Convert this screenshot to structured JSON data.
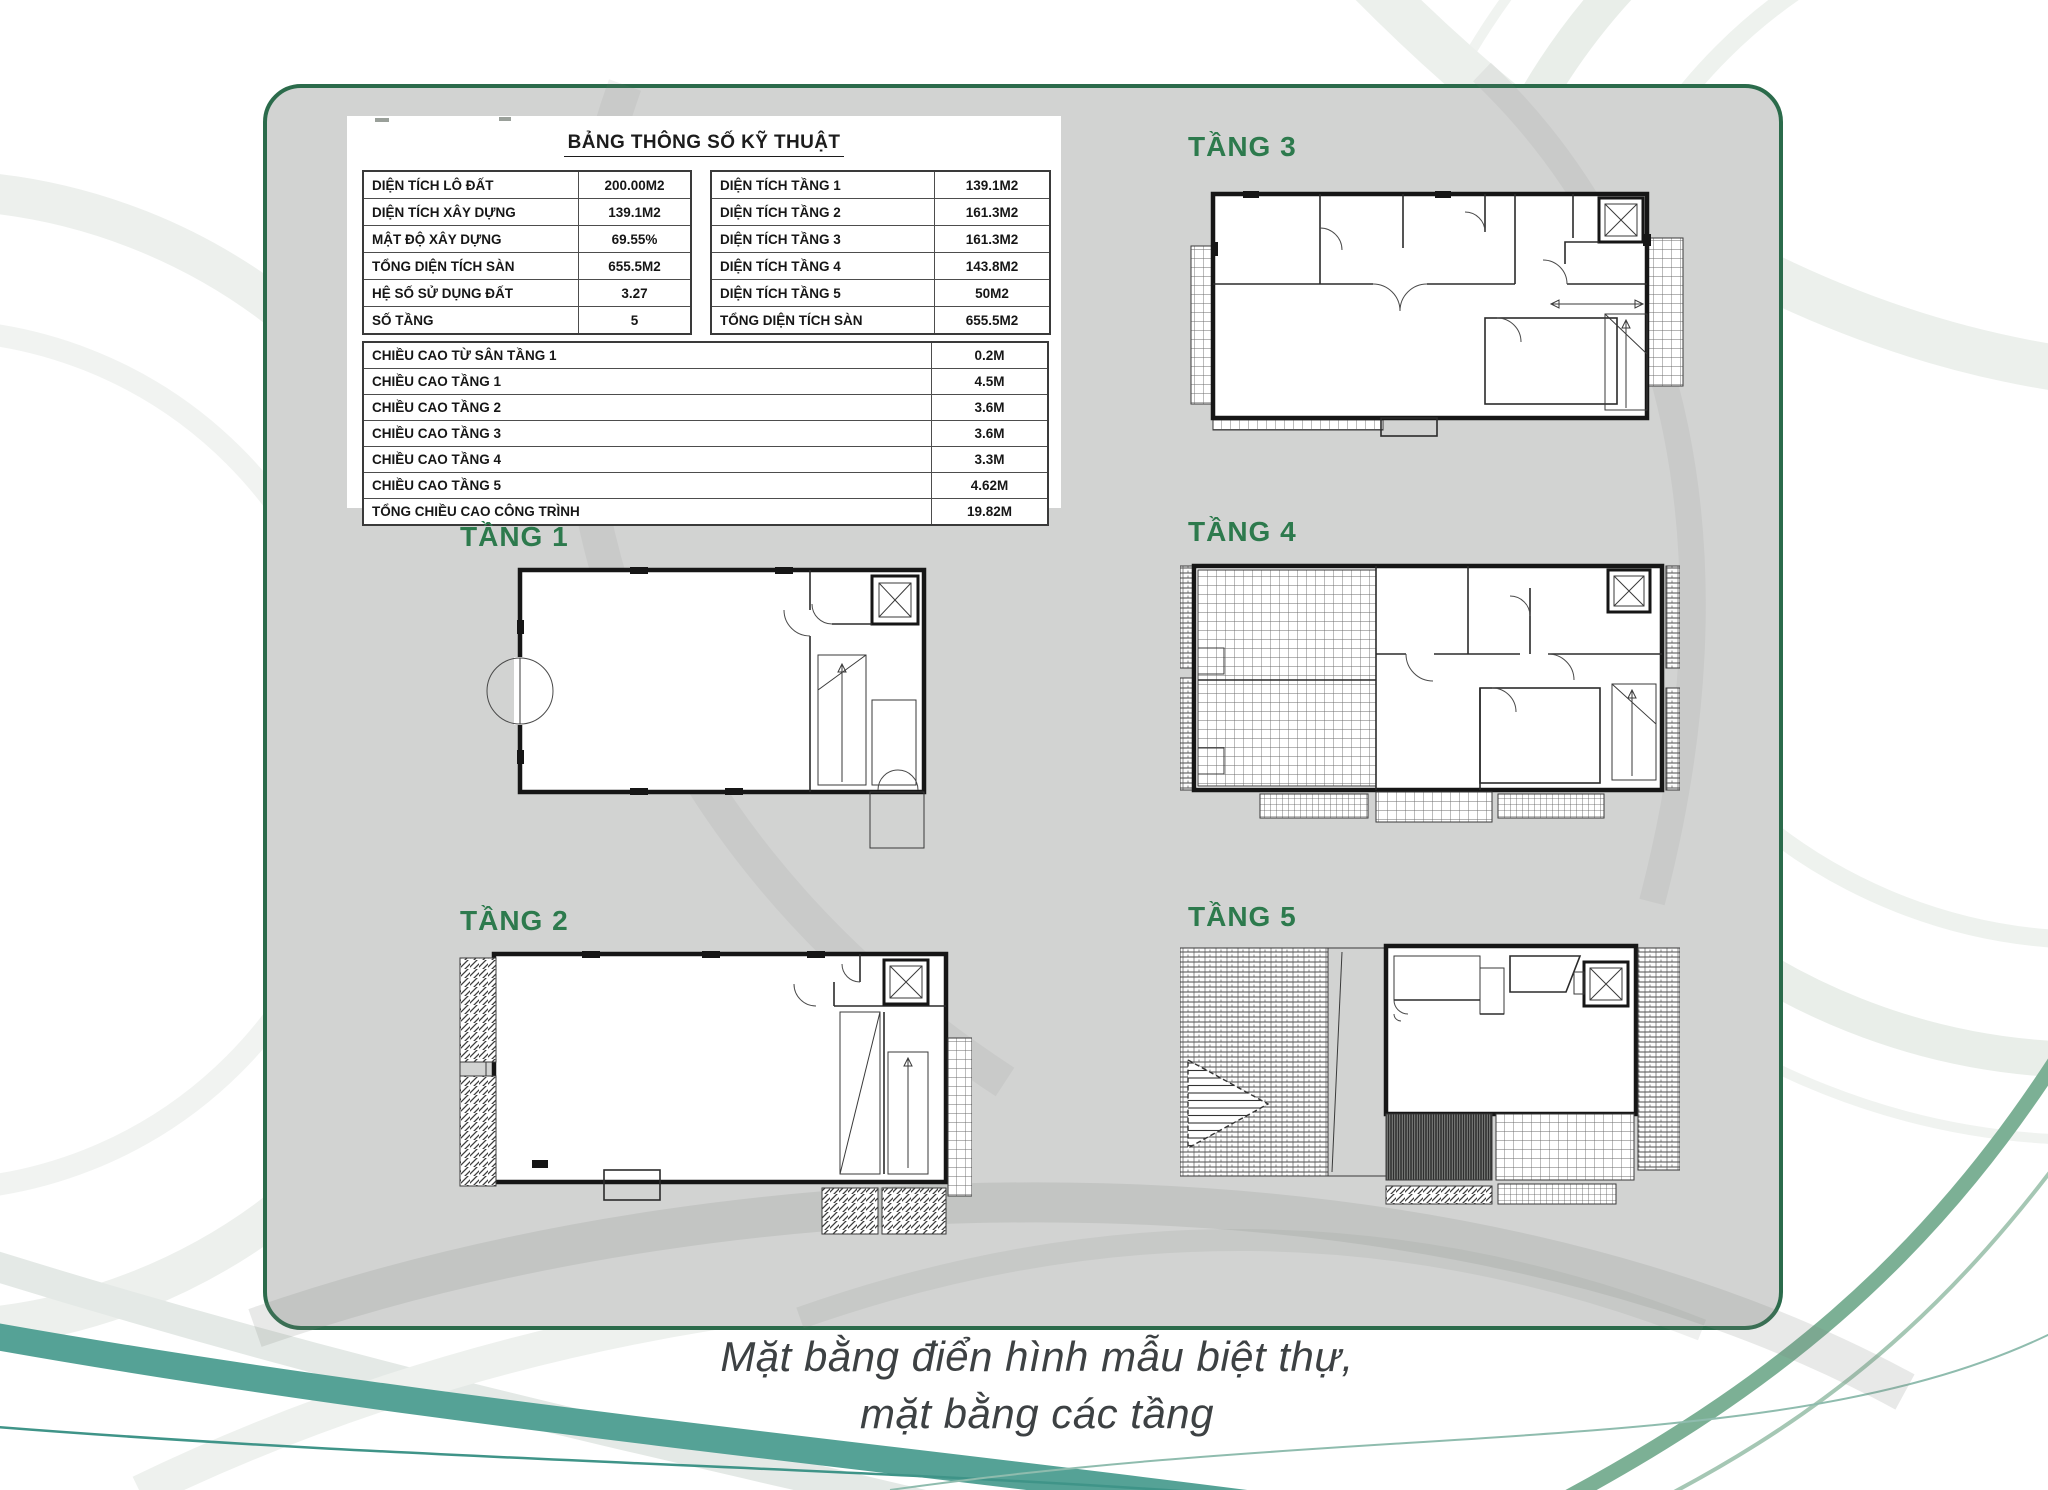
{
  "colors": {
    "accent_green": "#2d7a4d",
    "panel_border": "#2b6b4b",
    "panel_background": "#d2d3d2",
    "teal_swirl": "#55a296",
    "green_swirl": "#7cb095",
    "caption_text": "#3d4143"
  },
  "spec_table": {
    "title": "BẢNG THÔNG SỐ KỸ THUẬT",
    "site_rows": [
      {
        "label": "DIỆN TÍCH LÔ ĐẤT",
        "value": "200.00M2"
      },
      {
        "label": "DIỆN TÍCH XÂY DỰNG",
        "value": "139.1M2"
      },
      {
        "label": "MẬT ĐỘ XÂY DỰNG",
        "value": "69.55%"
      },
      {
        "label": "TỔNG DIỆN TÍCH SÀN",
        "value": "655.5M2"
      },
      {
        "label": "HỆ SỐ SỬ DỤNG ĐẤT",
        "value": "3.27"
      },
      {
        "label": "SỐ TẦNG",
        "value": "5"
      }
    ],
    "floor_area_rows": [
      {
        "label": "DIỆN TÍCH TẦNG 1",
        "value": "139.1M2"
      },
      {
        "label": "DIỆN TÍCH TẦNG 2",
        "value": "161.3M2"
      },
      {
        "label": "DIỆN TÍCH TẦNG 3",
        "value": "161.3M2"
      },
      {
        "label": "DIỆN TÍCH TẦNG 4",
        "value": "143.8M2"
      },
      {
        "label": "DIỆN TÍCH TẦNG 5",
        "value": "50M2"
      },
      {
        "label": "TỔNG DIỆN TÍCH SÀN",
        "value": "655.5M2"
      }
    ],
    "height_rows": [
      {
        "label": "CHIỀU CAO TỪ SÂN TẦNG 1",
        "value": "0.2M"
      },
      {
        "label": "CHIỀU CAO TẦNG 1",
        "value": "4.5M"
      },
      {
        "label": "CHIỀU CAO TẦNG 2",
        "value": "3.6M"
      },
      {
        "label": "CHIỀU CAO TẦNG 3",
        "value": "3.6M"
      },
      {
        "label": "CHIỀU CAO TẦNG 4",
        "value": "3.3M"
      },
      {
        "label": "CHIỀU CAO TẦNG 5",
        "value": "4.62M"
      },
      {
        "label": "TỔNG CHIỀU CAO CÔNG TRÌNH",
        "value": "19.82M"
      }
    ]
  },
  "floors": [
    {
      "id": "tang-1",
      "label": "TẦNG 1"
    },
    {
      "id": "tang-2",
      "label": "TẦNG 2"
    },
    {
      "id": "tang-3",
      "label": "TẦNG 3"
    },
    {
      "id": "tang-4",
      "label": "TẦNG 4"
    },
    {
      "id": "tang-5",
      "label": "TẦNG 5"
    }
  ],
  "caption": {
    "line1": "Mặt bằng điển hình mẫu biệt thự,",
    "line2": "mặt bằng các tầng"
  }
}
